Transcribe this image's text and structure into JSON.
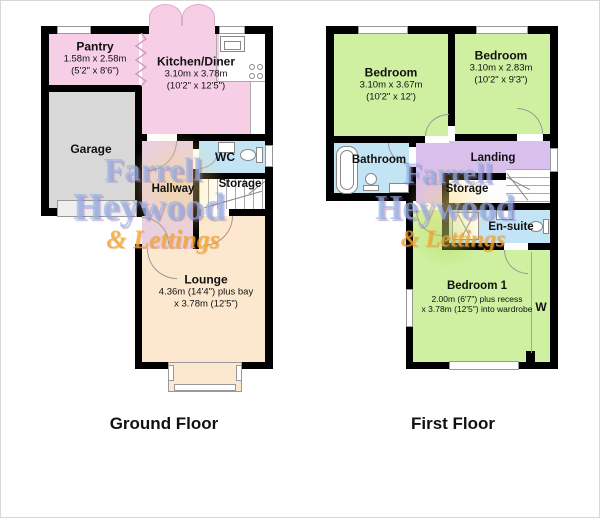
{
  "floors": {
    "ground": {
      "label": "Ground Floor",
      "rooms": {
        "pantry": {
          "name": "Pantry",
          "dim_m": "1.58m x 2.58m",
          "dim_ft": "(5'2\" x 8'6\")"
        },
        "kitchen": {
          "name": "Kitchen/Diner",
          "dim_m": "3.10m x 3.78m",
          "dim_ft": "(10'2\" x 12'5\")"
        },
        "garage": {
          "name": "Garage"
        },
        "wc": {
          "name": "WC"
        },
        "hallway": {
          "name": "Hallway"
        },
        "storage": {
          "name": "Storage"
        },
        "lounge": {
          "name": "Lounge",
          "dim_m": "4.36m (14'4\") plus bay",
          "dim_ft": "x 3.78m (12'5\")"
        }
      }
    },
    "first": {
      "label": "First Floor",
      "rooms": {
        "bedroom_left": {
          "name": "Bedroom",
          "dim_m": "3.10m x 3.67m",
          "dim_ft": "(10'2\" x 12')"
        },
        "bedroom_right": {
          "name": "Bedroom",
          "dim_m": "3.10m x 2.83m",
          "dim_ft": "(10'2\" x 9'3\")"
        },
        "bathroom": {
          "name": "Bathroom"
        },
        "landing": {
          "name": "Landing"
        },
        "storage": {
          "name": "Storage"
        },
        "ensuite": {
          "name": "En-suite"
        },
        "bedroom1": {
          "name": "Bedroom 1",
          "dim_m": "2.00m (6'7\") plus recess",
          "dim_ft": "x 3.78m (12'5\") into wardrobe"
        },
        "wardrobe": {
          "name": "W"
        }
      }
    }
  },
  "watermark": {
    "line1": "Farrell",
    "line2": "Heywood",
    "line3": "& Lettings"
  },
  "colors": {
    "wall": "#000000",
    "kitchen_pink": "#f6cfe6",
    "garage_gray": "#d8d8d8",
    "wet_room_blue": "#c2e4f5",
    "hallway_mauve": "#e8cfe3",
    "lounge_cream": "#fbe8ce",
    "bedroom_green": "#cff0a0",
    "landing_purple": "#d9bfec",
    "watermark_blue": "#96b4e4",
    "watermark_orange": "#f3a734"
  }
}
